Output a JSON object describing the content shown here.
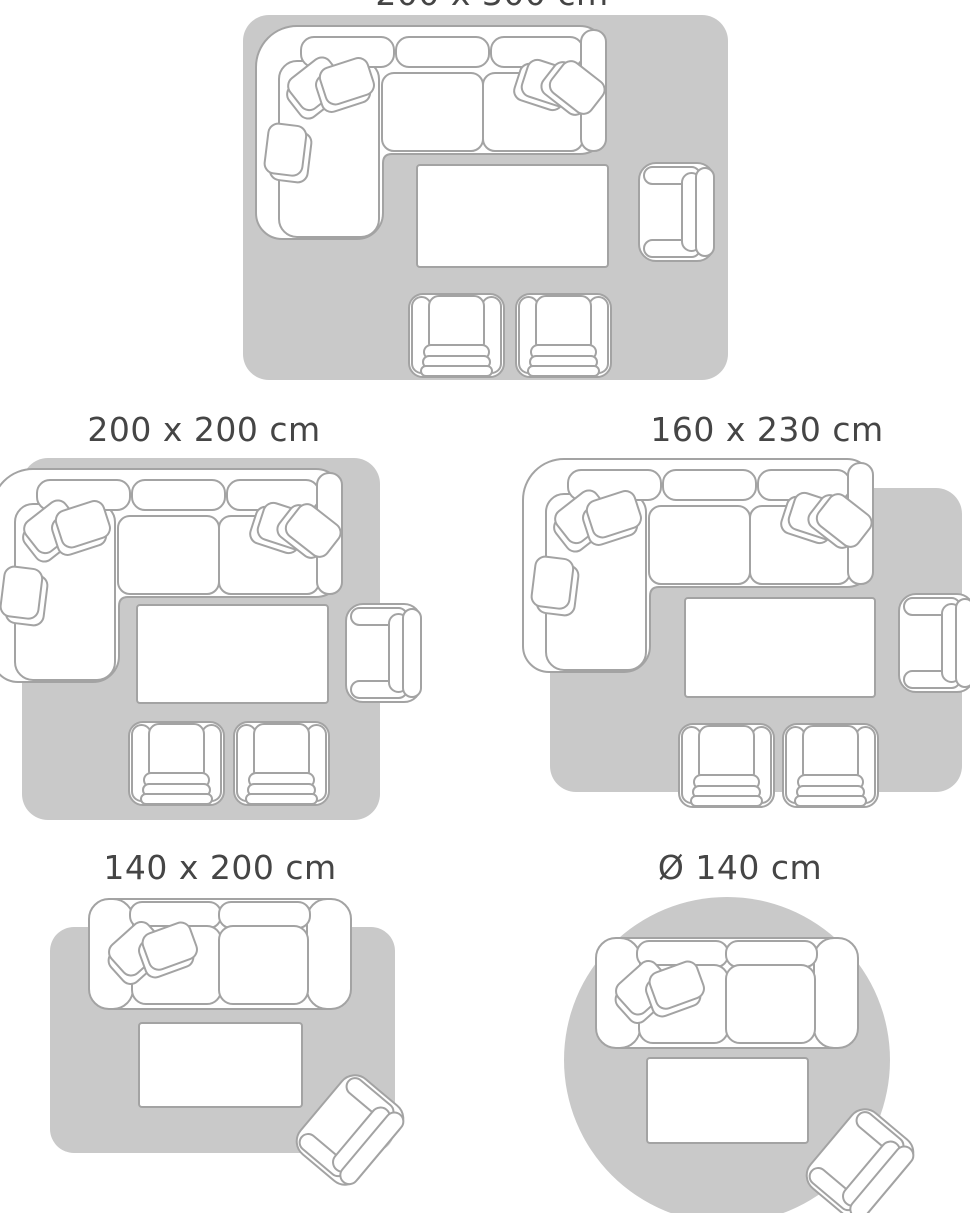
{
  "colors": {
    "rug": "#c9c9c9",
    "outline": "#a3a3a3",
    "fill": "#ffffff",
    "title": "#454545",
    "background": "#ffffff"
  },
  "diagrams": [
    {
      "label": "200 x 300 cm",
      "rug_shape": "rectangle",
      "furniture": [
        "corner sofa with cushions",
        "coffee table",
        "armchair",
        "two club chairs"
      ]
    },
    {
      "label": "200 x 200 cm",
      "rug_shape": "rectangle",
      "furniture": [
        "corner sofa with cushions",
        "coffee table",
        "armchair",
        "two club chairs"
      ]
    },
    {
      "label": "160 x 230 cm",
      "rug_shape": "rectangle",
      "furniture": [
        "corner sofa with cushions",
        "coffee table",
        "armchair",
        "two club chairs"
      ]
    },
    {
      "label": "140 x 200 cm",
      "rug_shape": "rectangle",
      "furniture": [
        "two-seat sofa with cushions",
        "coffee table",
        "tilted armchair"
      ]
    },
    {
      "label": "Ø 140 cm",
      "rug_shape": "circle",
      "furniture": [
        "two-seat sofa with cushions",
        "coffee table",
        "tilted armchair"
      ]
    }
  ]
}
